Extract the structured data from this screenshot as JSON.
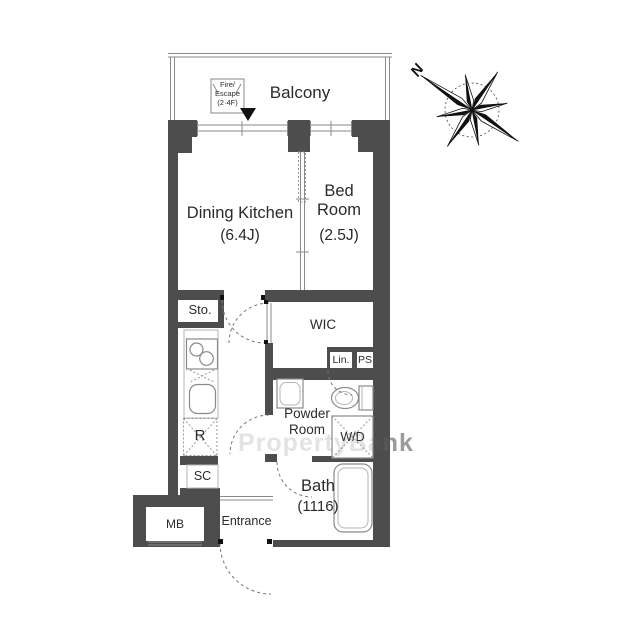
{
  "compass": {
    "north_label": "N"
  },
  "balcony": {
    "label": "Balcony",
    "fire_escape": {
      "line1": "Fire/",
      "line2": "Escape",
      "line3": "(2·4F)"
    }
  },
  "rooms": {
    "dining_kitchen": {
      "name": "Dining Kitchen",
      "size": "(6.4J)"
    },
    "bed_room": {
      "name": "Bed Room",
      "size": "(2.5J)"
    },
    "storage": {
      "name": "Sto."
    },
    "wic": {
      "name": "WIC"
    },
    "linen": {
      "name": "Lin."
    },
    "pipe_space": {
      "name": "PS"
    },
    "powder_room": {
      "name": "Powder Room"
    },
    "washer_dryer": {
      "name": "W/D"
    },
    "refrigerator": {
      "name": "R"
    },
    "shoe_closet": {
      "name": "SC"
    },
    "bath": {
      "name": "Bath",
      "size": "(1116)"
    },
    "meter_box": {
      "name": "MB"
    },
    "entrance": {
      "name": "Entrance"
    }
  },
  "watermark": {
    "part1": "PropertyBa",
    "part2": "nk"
  },
  "colors": {
    "wall": "#4d4d4d",
    "line": "#8a8a8a",
    "text": "#2b2b2b"
  }
}
